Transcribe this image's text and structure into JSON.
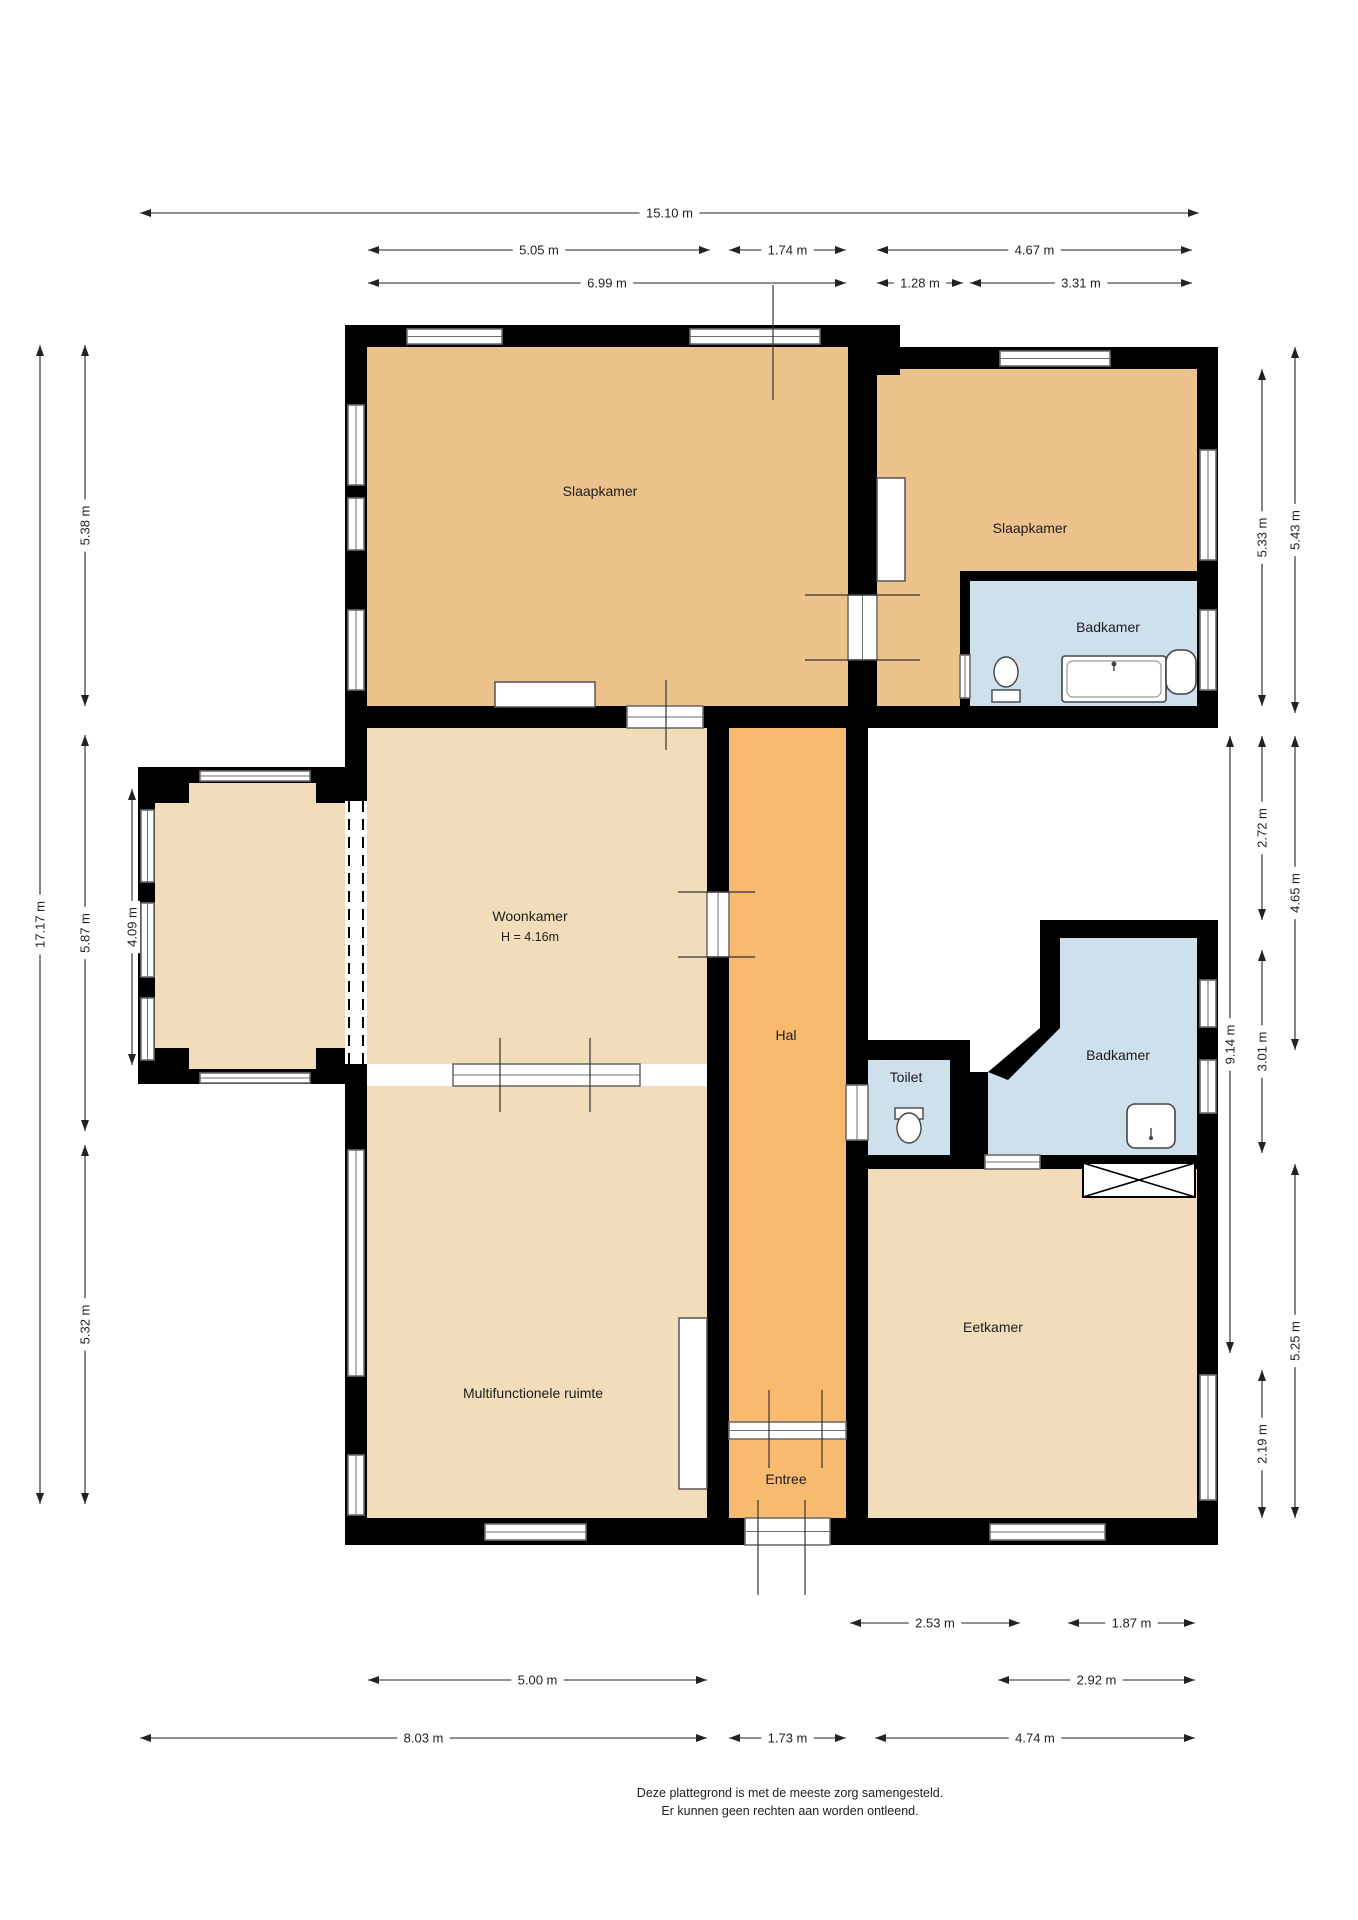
{
  "title": "Plattegrond",
  "footer": {
    "line1": "Deze plattegrond is met de meeste zorg samengesteld.",
    "line2": "Er kunnen geen rechten aan worden ontleend."
  },
  "colors": {
    "bedroom": "#ecc28c",
    "light": "#f1ddba",
    "hall": "#f7ba6e",
    "bath": "#cfe0ed",
    "wall": "#000000",
    "window_frame": "#6e6e6e",
    "tick": "#333333",
    "dim": "#222222",
    "fixture_stroke": "#444444",
    "background": "#ffffff"
  },
  "rooms": [
    {
      "name": "slaapkamer-1",
      "label": "Slaapkamer",
      "color": "bedroom",
      "rect": [
        367,
        345,
        510,
        361
      ],
      "label_xy": [
        600,
        496
      ]
    },
    {
      "name": "slaapkamer-2",
      "label": "Slaapkamer",
      "color": "bedroom",
      "rect": [
        877,
        369,
        320,
        337
      ],
      "label_xy": [
        1030,
        533
      ]
    },
    {
      "name": "badkamer-1",
      "label": "Badkamer",
      "color": "bath",
      "rect": [
        970,
        581,
        227,
        125
      ],
      "label_xy": [
        1108,
        632
      ]
    },
    {
      "name": "woonkamer",
      "label": "Woonkamer",
      "sublabel": "H = 4.16m",
      "color": "light",
      "rect": [
        367,
        728,
        340,
        336
      ],
      "label_xy": [
        530,
        921
      ]
    },
    {
      "name": "erker",
      "label": "",
      "color": "light",
      "rect": [
        155,
        783,
        212,
        286
      ],
      "label_xy": [
        260,
        920
      ]
    },
    {
      "name": "hal",
      "label": "Hal",
      "color": "hall",
      "rect": [
        729,
        728,
        117,
        694
      ],
      "label_xy": [
        786,
        1040
      ]
    },
    {
      "name": "entree",
      "label": "Entree",
      "color": "hall",
      "rect": [
        729,
        1439,
        117,
        79
      ],
      "label_xy": [
        786,
        1484
      ]
    },
    {
      "name": "toilet",
      "label": "Toilet",
      "color": "bath",
      "rect": [
        868,
        1060,
        82,
        95
      ],
      "label_xy": [
        906,
        1082
      ]
    },
    {
      "name": "badkamer-2",
      "label": "Badkamer",
      "color": "bath",
      "poly": [
        [
          1060,
          938
        ],
        [
          1197,
          938
        ],
        [
          1197,
          1155
        ],
        [
          970,
          1155
        ],
        [
          970,
          1072
        ],
        [
          1008,
          1072
        ],
        [
          1060,
          1022
        ]
      ],
      "label_xy": [
        1118,
        1060
      ]
    },
    {
      "name": "multifunctionele-ruimte",
      "label": "Multifunctionele ruimte",
      "color": "light",
      "rect": [
        367,
        1086,
        340,
        432
      ],
      "label_xy": [
        533,
        1398
      ]
    },
    {
      "name": "eetkamer",
      "label": "Eetkamer",
      "color": "light",
      "rect": [
        868,
        1169,
        329,
        349
      ],
      "label_xy": [
        993,
        1332
      ]
    }
  ],
  "walls": [
    {
      "name": "top-wall-left",
      "rect": [
        345,
        325,
        555,
        22
      ]
    },
    {
      "name": "top-wall-right",
      "rect": [
        877,
        347,
        341,
        22
      ]
    },
    {
      "name": "left-wall",
      "rect": [
        345,
        325,
        22,
        1220
      ]
    },
    {
      "name": "right-wall-upper",
      "rect": [
        1197,
        347,
        21,
        381
      ]
    },
    {
      "name": "right-wall-lower",
      "rect": [
        1197,
        920,
        21,
        625
      ]
    },
    {
      "name": "bottom-wall",
      "rect": [
        345,
        1518,
        873,
        27
      ]
    },
    {
      "name": "bedroom-bottom-wall",
      "rect": [
        345,
        706,
        873,
        22
      ]
    },
    {
      "name": "bedroom-divider-wall",
      "rect": [
        848,
        325,
        29,
        403
      ]
    },
    {
      "name": "divider-pilaster",
      "rect": [
        848,
        347,
        52,
        28
      ]
    },
    {
      "name": "woonkamer-hal-wall",
      "rect": [
        707,
        728,
        22,
        790
      ]
    },
    {
      "name": "hal-right-wall",
      "rect": [
        846,
        728,
        22,
        790
      ]
    },
    {
      "name": "toilet-top-wall",
      "rect": [
        846,
        1040,
        124,
        20
      ]
    },
    {
      "name": "toilet-right-wall",
      "rect": [
        950,
        1060,
        20,
        95
      ]
    },
    {
      "name": "badkamer2-top-wall",
      "rect": [
        1040,
        920,
        157,
        18
      ]
    },
    {
      "name": "badkamer2-left-wall",
      "rect": [
        1040,
        938,
        20,
        90
      ]
    },
    {
      "name": "badkamer2-left-lower-wall",
      "rect": [
        970,
        1072,
        18,
        83
      ]
    },
    {
      "name": "badkamer1-left-wall",
      "rect": [
        960,
        571,
        10,
        135
      ]
    },
    {
      "name": "badkamer1-top-wall",
      "rect": [
        960,
        571,
        237,
        10
      ]
    },
    {
      "name": "bathband-bottom-wall",
      "rect": [
        846,
        1155,
        352,
        14
      ]
    },
    {
      "name": "bay-top-wall",
      "rect": [
        138,
        767,
        229,
        16
      ]
    },
    {
      "name": "bay-bottom-wall",
      "rect": [
        138,
        1069,
        229,
        15
      ]
    },
    {
      "name": "bay-left-wall",
      "rect": [
        138,
        767,
        17,
        317
      ]
    },
    {
      "name": "bay-corner-tl",
      "rect": [
        138,
        767,
        51,
        36
      ]
    },
    {
      "name": "bay-corner-bl",
      "rect": [
        138,
        1048,
        51,
        36
      ]
    },
    {
      "name": "bay-corner-tr",
      "rect": [
        316,
        767,
        51,
        36
      ]
    },
    {
      "name": "bay-corner-br",
      "rect": [
        316,
        1048,
        51,
        36
      ]
    },
    {
      "name": "bay-pier-1",
      "rect": [
        138,
        885,
        17,
        15
      ]
    },
    {
      "name": "bay-pier-2",
      "rect": [
        138,
        980,
        17,
        15
      ]
    }
  ],
  "wall_polys": [
    {
      "name": "badkamer2-diagonal-wall",
      "pts": [
        [
          1040,
          1028
        ],
        [
          1060,
          1028
        ],
        [
          1008,
          1080
        ],
        [
          988,
          1072
        ]
      ]
    }
  ],
  "windows": [
    {
      "name": "window-top-1",
      "rect": [
        407,
        329,
        95,
        15
      ]
    },
    {
      "name": "window-top-2",
      "rect": [
        690,
        329,
        130,
        15
      ]
    },
    {
      "name": "window-top-right",
      "rect": [
        1000,
        351,
        110,
        15
      ]
    },
    {
      "name": "window-left-1",
      "rect": [
        348,
        405,
        16,
        80
      ]
    },
    {
      "name": "window-left-2",
      "rect": [
        348,
        498,
        16,
        52
      ]
    },
    {
      "name": "window-left-3",
      "rect": [
        348,
        610,
        16,
        80
      ]
    },
    {
      "name": "window-left-4",
      "rect": [
        348,
        1150,
        16,
        226
      ]
    },
    {
      "name": "window-left-5",
      "rect": [
        348,
        1455,
        16,
        60
      ]
    },
    {
      "name": "window-bay-left-1",
      "rect": [
        141,
        810,
        13,
        72
      ]
    },
    {
      "name": "window-bay-left-2",
      "rect": [
        141,
        903,
        13,
        74
      ]
    },
    {
      "name": "window-bay-left-3",
      "rect": [
        141,
        998,
        13,
        62
      ]
    },
    {
      "name": "window-bay-top",
      "rect": [
        200,
        771,
        110,
        10
      ]
    },
    {
      "name": "window-bay-bottom",
      "rect": [
        200,
        1073,
        110,
        10
      ]
    },
    {
      "name": "window-right-1",
      "rect": [
        1200,
        450,
        16,
        110
      ]
    },
    {
      "name": "window-right-2",
      "rect": [
        1200,
        610,
        16,
        80
      ]
    },
    {
      "name": "window-right-3",
      "rect": [
        1200,
        980,
        16,
        47
      ]
    },
    {
      "name": "window-right-4",
      "rect": [
        1200,
        1060,
        16,
        53
      ]
    },
    {
      "name": "window-right-5",
      "rect": [
        1200,
        1375,
        16,
        125
      ]
    },
    {
      "name": "window-bottom-1",
      "rect": [
        485,
        1524,
        101,
        16
      ]
    },
    {
      "name": "window-bottom-2",
      "rect": [
        990,
        1524,
        115,
        16
      ]
    }
  ],
  "openings": [
    {
      "name": "opening-bedroom1-woonkamer",
      "rect": [
        627,
        706,
        76,
        22
      ]
    },
    {
      "name": "door-bedroom-divider",
      "rect": [
        848,
        595,
        29,
        65
      ]
    },
    {
      "name": "door-woonkamer-hal",
      "rect": [
        707,
        892,
        22,
        65
      ]
    },
    {
      "name": "opening-woonkamer-multifunctionele",
      "rect": [
        453,
        1064,
        187,
        22
      ]
    },
    {
      "name": "door-hal-entree",
      "rect": [
        729,
        1422,
        117,
        17
      ]
    },
    {
      "name": "door-toilet",
      "rect": [
        846,
        1085,
        22,
        55
      ]
    },
    {
      "name": "door-badkamer1",
      "rect": [
        960,
        655,
        10,
        43
      ]
    },
    {
      "name": "door-badkamer2",
      "rect": [
        985,
        1155,
        55,
        14
      ]
    },
    {
      "name": "entrance-door",
      "rect": [
        745,
        1518,
        85,
        27
      ]
    }
  ],
  "dashed_opening": {
    "name": "bay-woonkamer-opening",
    "rect": [
      345,
      801,
      22,
      263
    ]
  },
  "ticks": [
    {
      "name": "tick-topwall",
      "x1": 773,
      "y1": 285,
      "x2": 773,
      "y2": 400
    },
    {
      "name": "tick-divider-a",
      "x1": 805,
      "y1": 595,
      "x2": 920,
      "y2": 595
    },
    {
      "name": "tick-divider-b",
      "x1": 805,
      "y1": 660,
      "x2": 920,
      "y2": 660
    },
    {
      "name": "tick-opening1",
      "x1": 666,
      "y1": 680,
      "x2": 666,
      "y2": 750
    },
    {
      "name": "tick-hal-a",
      "x1": 678,
      "y1": 892,
      "x2": 755,
      "y2": 892
    },
    {
      "name": "tick-hal-b",
      "x1": 678,
      "y1": 957,
      "x2": 755,
      "y2": 957
    },
    {
      "name": "tick-woonk-a",
      "x1": 500,
      "y1": 1038,
      "x2": 500,
      "y2": 1112
    },
    {
      "name": "tick-woonk-b",
      "x1": 590,
      "y1": 1038,
      "x2": 590,
      "y2": 1112
    },
    {
      "name": "tick-entree-a",
      "x1": 769,
      "y1": 1390,
      "x2": 769,
      "y2": 1468
    },
    {
      "name": "tick-entree-b",
      "x1": 822,
      "y1": 1390,
      "x2": 822,
      "y2": 1468
    },
    {
      "name": "tick-entrance-a",
      "x1": 758,
      "y1": 1500,
      "x2": 758,
      "y2": 1595
    },
    {
      "name": "tick-entrance-b",
      "x1": 805,
      "y1": 1500,
      "x2": 805,
      "y2": 1595
    }
  ],
  "closets": [
    {
      "name": "closet-slaapkamer1",
      "rect": [
        495,
        682,
        100,
        25
      ]
    },
    {
      "name": "closet-slaapkamer2",
      "rect": [
        877,
        478,
        28,
        103
      ]
    },
    {
      "name": "closet-multifunctionele",
      "rect": [
        679,
        1318,
        28,
        171
      ]
    }
  ],
  "cabinet_x": {
    "name": "kast-eetkamer",
    "rect": [
      1083,
      1163,
      112,
      34
    ]
  },
  "fixtures": {
    "bath": {
      "outer": [
        1062,
        656,
        104,
        46
      ],
      "inner": [
        1067,
        661,
        94,
        36
      ],
      "faucet": [
        1114,
        664
      ]
    },
    "sink1": {
      "rect": [
        1166,
        650,
        30,
        44
      ]
    },
    "toilet1": {
      "bowl": [
        1006,
        672,
        12,
        15
      ],
      "tank": [
        992,
        690,
        28,
        12
      ]
    },
    "toilet2": {
      "bowl": [
        909,
        1128,
        12,
        15
      ],
      "tank": [
        895,
        1108,
        28,
        11
      ]
    },
    "sink2": {
      "rect": [
        1127,
        1104,
        48,
        44
      ],
      "tap": [
        1151,
        1136
      ]
    }
  },
  "dimensions": [
    {
      "label": "15.10 m",
      "x1": 140,
      "y1": 213,
      "x2": 1199,
      "y2": 213
    },
    {
      "label": "5.05 m",
      "x1": 368,
      "y1": 250,
      "x2": 710,
      "y2": 250
    },
    {
      "label": "1.74 m",
      "x1": 729,
      "y1": 250,
      "x2": 846,
      "y2": 250
    },
    {
      "label": "4.67 m",
      "x1": 877,
      "y1": 250,
      "x2": 1192,
      "y2": 250
    },
    {
      "label": "6.99 m",
      "x1": 368,
      "y1": 283,
      "x2": 846,
      "y2": 283
    },
    {
      "label": "1.28 m",
      "x1": 877,
      "y1": 283,
      "x2": 963,
      "y2": 283
    },
    {
      "label": "3.31 m",
      "x1": 970,
      "y1": 283,
      "x2": 1192,
      "y2": 283
    },
    {
      "label": "2.53 m",
      "x1": 850,
      "y1": 1623,
      "x2": 1020,
      "y2": 1623
    },
    {
      "label": "1.87 m",
      "x1": 1068,
      "y1": 1623,
      "x2": 1195,
      "y2": 1623
    },
    {
      "label": "5.00 m",
      "x1": 368,
      "y1": 1680,
      "x2": 707,
      "y2": 1680
    },
    {
      "label": "2.92 m",
      "x1": 998,
      "y1": 1680,
      "x2": 1195,
      "y2": 1680
    },
    {
      "label": "8.03 m",
      "x1": 140,
      "y1": 1738,
      "x2": 707,
      "y2": 1738
    },
    {
      "label": "1.73 m",
      "x1": 729,
      "y1": 1738,
      "x2": 846,
      "y2": 1738
    },
    {
      "label": "4.74 m",
      "x1": 875,
      "y1": 1738,
      "x2": 1195,
      "y2": 1738
    },
    {
      "label": "17.17 m",
      "x1": 40,
      "y1": 345,
      "x2": 40,
      "y2": 1504
    },
    {
      "label": "5.38 m",
      "x1": 85,
      "y1": 345,
      "x2": 85,
      "y2": 706
    },
    {
      "label": "5.87 m",
      "x1": 85,
      "y1": 735,
      "x2": 85,
      "y2": 1131
    },
    {
      "label": "5.32 m",
      "x1": 85,
      "y1": 1145,
      "x2": 85,
      "y2": 1504
    },
    {
      "label": "4.09 m",
      "x1": 132,
      "y1": 789,
      "x2": 132,
      "y2": 1065
    },
    {
      "label": "9.14 m",
      "x1": 1230,
      "y1": 736,
      "x2": 1230,
      "y2": 1353
    },
    {
      "label": "5.33 m",
      "x1": 1262,
      "y1": 369,
      "x2": 1262,
      "y2": 706
    },
    {
      "label": "2.72 m",
      "x1": 1262,
      "y1": 736,
      "x2": 1262,
      "y2": 920
    },
    {
      "label": "3.01 m",
      "x1": 1262,
      "y1": 950,
      "x2": 1262,
      "y2": 1153
    },
    {
      "label": "2.19 m",
      "x1": 1262,
      "y1": 1370,
      "x2": 1262,
      "y2": 1518
    },
    {
      "label": "5.43 m",
      "x1": 1295,
      "y1": 347,
      "x2": 1295,
      "y2": 713
    },
    {
      "label": "4.65 m",
      "x1": 1295,
      "y1": 736,
      "x2": 1295,
      "y2": 1050
    },
    {
      "label": "5.25 m",
      "x1": 1295,
      "y1": 1164,
      "x2": 1295,
      "y2": 1518
    }
  ]
}
